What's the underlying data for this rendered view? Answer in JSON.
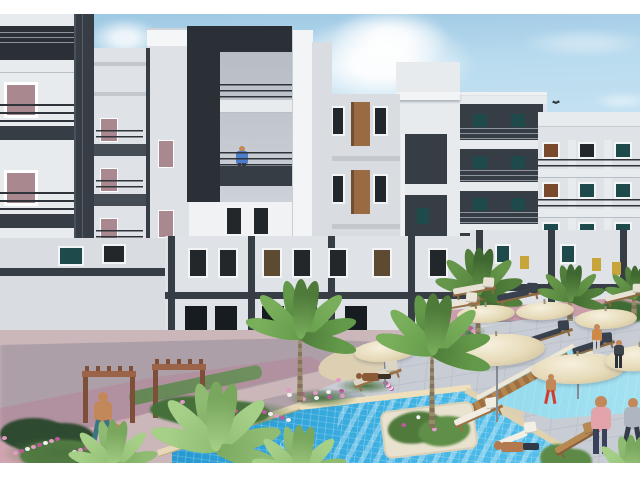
{
  "meta": {
    "description": "3D architectural rendering of a white-and-charcoal residential apartment compound courtyard with two blue swimming pools, palm trees, cream sun umbrellas, wooden pergolas, flower beds and small human figures",
    "image_width": 640,
    "image_height": 480,
    "top_border_px": 14,
    "bottom_border_px": 17
  },
  "palette": {
    "sky_top": "#9fc9e4",
    "sky_mid": "#badcef",
    "sky_low": "#d8ecf6",
    "facade_bright": "#f0f2f4",
    "facade_light": "#e8ebee",
    "facade_mid": "#dfe3e7",
    "facade_dim": "#d3d8dd",
    "facade_dim2": "#d9dde2",
    "facade_shade": "#c3c9cf",
    "facade_edge": "#c2c8ce",
    "charcoal": "#373d44",
    "charcoal_dark": "#2b3036",
    "charcoal_soft": "#464d55",
    "railing": "#2e343a",
    "window_dark": "#22272c",
    "window_teal": "#1e4a4b",
    "window_brown": "#7a4a2c",
    "window_rose": "#a9898f",
    "window_black": "#171c20",
    "window_yellow": "#c8a53a",
    "panel_brown": "#9a6a42",
    "panel_brown_dark": "#5d4a33",
    "door_green": "#24402e",
    "pool_deep": "#1d86c2",
    "pool_light": "#5cc3ec",
    "pool2_a": "#57bfe0",
    "pool2_b": "#a5e2f1",
    "coping": "#e9dbb9",
    "deck": "#c8cdd5",
    "deck_line": "#b2b8c1",
    "walk_pink": "#d0a4b0",
    "walk_pink2": "#cb9ba8",
    "base_mauve": "#cbb6ba",
    "grass": "#7ba35c",
    "sand": "#dccfb2",
    "flower_pink": "#e49ac6",
    "flower_magenta": "#bc5a9b",
    "flower_white": "#f3f1f3",
    "umbrella": "#e6dab8",
    "wood": "#9b6347",
    "wood_dark": "#7e4f38",
    "skin": "#c2885a"
  },
  "scene": {
    "buildings": [
      {
        "name": "left-tower",
        "style": "white with charcoal side band, 3 balconies"
      },
      {
        "name": "left-slim-tower",
        "style": "narrow white, 3 small balconies"
      },
      {
        "name": "center-tower",
        "style": "white with dark L-frame and balcony recess, man on balcony"
      },
      {
        "name": "mid-tower",
        "style": "white, brown spandrel panels, charcoal balcony column"
      },
      {
        "name": "frame-tower",
        "style": "charcoal picture-frame facade with white slabs"
      },
      {
        "name": "right-block",
        "style": "white, 3 rows of balconies with teal/brown windows"
      },
      {
        "name": "courtyard-wings",
        "style": "two-storey white wings with charcoal pilasters"
      }
    ],
    "clouds": [
      {
        "x": 285,
        "y": 16,
        "w": 190,
        "h": 95,
        "o": 0.95
      },
      {
        "x": 330,
        "y": 8,
        "w": 120,
        "h": 60,
        "o": 0.9
      },
      {
        "x": 90,
        "y": 18,
        "w": 70,
        "h": 40,
        "o": 0.8
      },
      {
        "x": 520,
        "y": 28,
        "w": 130,
        "h": 30,
        "o": 0.35
      },
      {
        "x": 592,
        "y": 92,
        "w": 60,
        "h": 18,
        "o": 0.4
      }
    ],
    "bird": {
      "x": 552,
      "y": 99
    },
    "pools": [
      {
        "name": "main-pool",
        "water": "deep azure tiled, stair stripes right side, swimmer"
      },
      {
        "name": "right-pool",
        "water": "light cyan, wooden deck edge, umbrellas over corner"
      }
    ],
    "pergola": {
      "arches": [
        {
          "x": 82,
          "y": 366,
          "w": 54,
          "ph": 46
        },
        {
          "x": 152,
          "y": 359,
          "w": 54,
          "ph": 48
        }
      ]
    },
    "palms": [
      {
        "x": 300,
        "y": 336,
        "s": 115,
        "trunk": 70,
        "tone": "mid",
        "z": 50
      },
      {
        "x": 432,
        "y": 352,
        "s": 120,
        "trunk": 80,
        "tone": "mid",
        "z": 50
      },
      {
        "x": 478,
        "y": 292,
        "s": 92,
        "trunk": 60,
        "tone": "dark",
        "z": 30
      },
      {
        "x": 570,
        "y": 299,
        "s": 74,
        "trunk": 26,
        "tone": "dark",
        "z": 28
      },
      {
        "x": 634,
        "y": 297,
        "s": 66,
        "trunk": 22,
        "tone": "dark",
        "z": 28
      },
      {
        "x": 215,
        "y": 448,
        "s": 135,
        "trunk": 0,
        "tone": "light",
        "z": 52
      },
      {
        "x": 112,
        "y": 466,
        "s": 95,
        "trunk": 0,
        "tone": "light",
        "z": 52
      },
      {
        "x": 298,
        "y": 474,
        "s": 100,
        "trunk": 0,
        "tone": "light",
        "z": 52
      },
      {
        "x": 630,
        "y": 476,
        "s": 85,
        "trunk": 0,
        "tone": "light",
        "z": 52
      }
    ],
    "umbrellas": [
      {
        "x": 385,
        "y": 351,
        "w": 62,
        "h": 22,
        "rot": -4,
        "pole": 36,
        "z": 40
      },
      {
        "x": 497,
        "y": 350,
        "w": 96,
        "h": 32,
        "rot": -3,
        "pole": 72,
        "z": 40
      },
      {
        "x": 578,
        "y": 369,
        "w": 94,
        "h": 30,
        "rot": -2,
        "pole": 30,
        "z": 40
      },
      {
        "x": 486,
        "y": 314,
        "w": 58,
        "h": 18,
        "rot": -3,
        "pole": 0,
        "z": 32
      },
      {
        "x": 545,
        "y": 311,
        "w": 58,
        "h": 18,
        "rot": -3,
        "pole": 0,
        "z": 32
      },
      {
        "x": 606,
        "y": 319,
        "w": 62,
        "h": 20,
        "rot": -2,
        "pole": 0,
        "z": 32
      },
      {
        "x": 641,
        "y": 358,
        "w": 72,
        "h": 26,
        "rot": -6,
        "pole": 0,
        "z": 40
      }
    ],
    "loungers": [
      {
        "x": 452,
        "y": 404,
        "w": 52,
        "rot": -24,
        "pad": "#f1ede3",
        "frame": "#9a7146",
        "z": 38
      },
      {
        "x": 527,
        "y": 325,
        "w": 46,
        "rot": -18,
        "pad": "#39414e",
        "frame": "#8d6a42",
        "z": 36
      },
      {
        "x": 571,
        "y": 337,
        "w": 44,
        "rot": -18,
        "pad": "#39414e",
        "frame": "#8d6a42",
        "z": 36
      },
      {
        "x": 604,
        "y": 287,
        "w": 42,
        "rot": -14,
        "pad": "#e7e2d4",
        "frame": "#8d6a42",
        "z": 34
      },
      {
        "x": 552,
        "y": 430,
        "w": 50,
        "rot": -30,
        "pad": "#b68952",
        "frame": "#8a5f38",
        "z": 44
      },
      {
        "x": 434,
        "y": 295,
        "w": 46,
        "rot": -10,
        "pad": "#eae5d8",
        "frame": "#9a7146",
        "z": 34
      },
      {
        "x": 352,
        "y": 366,
        "w": 50,
        "rot": -20,
        "pad": "#ddd5c4",
        "frame": "#9a7146",
        "z": 40
      },
      {
        "x": 492,
        "y": 428,
        "w": 48,
        "rot": -22,
        "pad": "#f2efe6",
        "frame": "",
        "z": 42
      },
      {
        "x": 452,
        "y": 280,
        "w": 44,
        "rot": -10,
        "pad": "#e7e2d4",
        "frame": "#8d6a42",
        "z": 30
      },
      {
        "x": 496,
        "y": 286,
        "w": 44,
        "rot": -12,
        "pad": "#39414e",
        "frame": "#8d6a42",
        "z": 30
      }
    ],
    "bushes": [
      {
        "x": 0,
        "y": 418,
        "w": 95,
        "h": 36,
        "c": "#2e4a30",
        "z": 20
      },
      {
        "x": 150,
        "y": 396,
        "w": 120,
        "h": 30,
        "c": "#46703a",
        "z": 30
      },
      {
        "x": 540,
        "y": 444,
        "w": 52,
        "h": 30,
        "c": "#5d8a46",
        "z": 44
      },
      {
        "x": 440,
        "y": 338,
        "w": 80,
        "h": 24,
        "c": "#466f3a",
        "z": 30
      },
      {
        "x": 20,
        "y": 440,
        "w": 120,
        "h": 34,
        "c": "#557f41",
        "z": 42
      },
      {
        "x": 600,
        "y": 300,
        "w": 50,
        "h": 22,
        "c": "#3f6b35",
        "z": 28
      },
      {
        "x": 470,
        "y": 300,
        "w": 40,
        "h": 20,
        "c": "#3f6b35",
        "z": 28
      }
    ],
    "flower_beds": [
      {
        "x": 2,
        "y": 436,
        "w": 118,
        "h": 34,
        "n": 16,
        "z": 43
      },
      {
        "x": 180,
        "y": 400,
        "w": 118,
        "h": 26,
        "n": 14,
        "z": 31
      },
      {
        "x": 286,
        "y": 388,
        "w": 72,
        "h": 20,
        "n": 10,
        "z": 31
      },
      {
        "x": 452,
        "y": 322,
        "w": 34,
        "h": 22,
        "n": 8,
        "z": 29
      },
      {
        "x": 336,
        "y": 378,
        "w": 60,
        "h": 16,
        "n": 8,
        "z": 31
      }
    ],
    "people": [
      {
        "name": "person-balcony-man",
        "x": 242,
        "y": 146,
        "h": 32,
        "pose": "stand",
        "top": "#4f7cc9",
        "bottom": "#39424e",
        "z": 45
      },
      {
        "name": "person-swimmer",
        "x": 297,
        "y": 438,
        "pose": "swim",
        "top": "#e8eef2",
        "z": 26
      },
      {
        "name": "person-walking-man",
        "x": 103,
        "y": 392,
        "h": 50,
        "pose": "walk",
        "top": "#c2885a",
        "bottom": "#3a7580",
        "z": 46
      },
      {
        "name": "person-child",
        "x": 117,
        "y": 424,
        "h": 22,
        "pose": "stand",
        "top": "#c2885a",
        "bottom": "#6b5036",
        "z": 46
      },
      {
        "name": "person-child-red-shorts",
        "x": 551,
        "y": 374,
        "h": 30,
        "pose": "walk",
        "top": "#c2885a",
        "bottom": "#d23c2e",
        "z": 46
      },
      {
        "name": "person-woman-pink",
        "x": 601,
        "y": 396,
        "h": 58,
        "pose": "stand",
        "top": "#e2a3ab",
        "bottom": "#39415a",
        "z": 46
      },
      {
        "name": "person-sunbather",
        "x": 494,
        "y": 438,
        "len": 46,
        "pose": "lie",
        "top": "#b27a4e",
        "bottom": "#2f3a46",
        "z": 44
      },
      {
        "name": "person-woman-orange",
        "x": 597,
        "y": 324,
        "h": 30,
        "pose": "stand",
        "top": "#cd8947",
        "bottom": "#c9cdd2",
        "z": 42
      },
      {
        "name": "person-standing-dark",
        "x": 619,
        "y": 340,
        "h": 28,
        "pose": "stand",
        "top": "#3c434b",
        "bottom": "#2b323a",
        "z": 42
      },
      {
        "name": "person-walking-right",
        "x": 633,
        "y": 398,
        "h": 52,
        "pose": "walk",
        "top": "#aeb6c2",
        "bottom": "#333c49",
        "z": 46
      },
      {
        "name": "person-on-lounger",
        "x": 356,
        "y": 370,
        "len": 36,
        "pose": "lie",
        "top": "#8a5a36",
        "bottom": "#3c3026",
        "z": 44
      }
    ]
  }
}
